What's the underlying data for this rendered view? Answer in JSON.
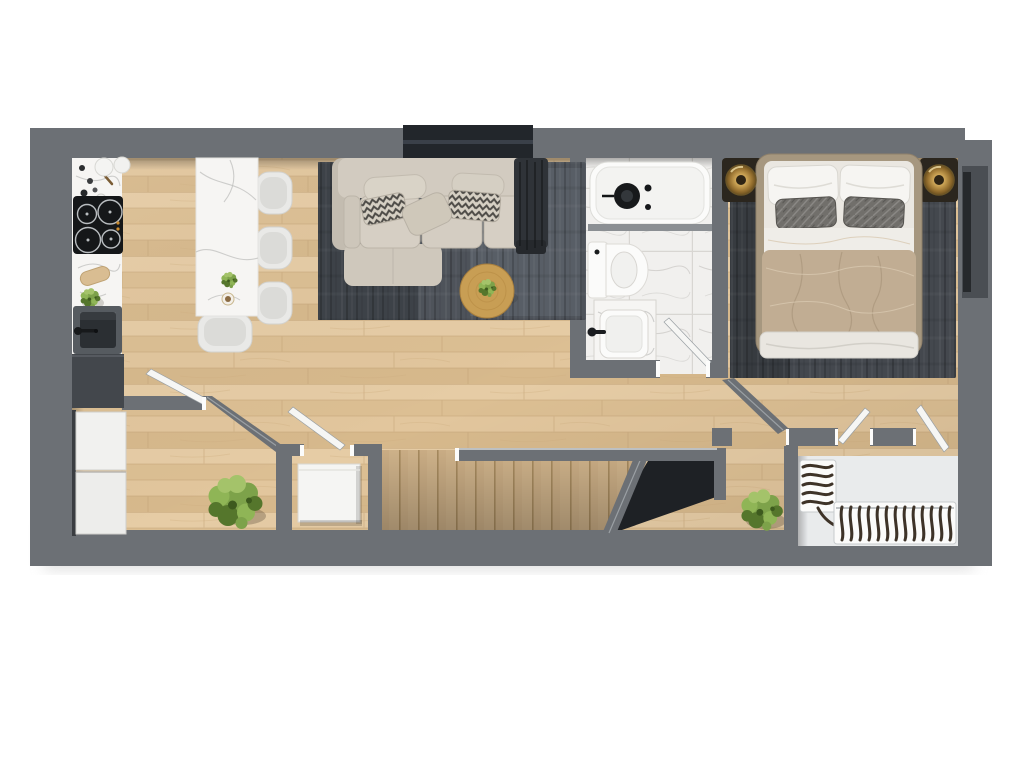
{
  "meta": {
    "title": "Apartment floor plan - photorealistic top-down 3D render",
    "view": "top-down orthographic",
    "text_visible": "none"
  },
  "colors": {
    "background": "#ffffff",
    "wall": "#6c7075",
    "wall_light": "#8d9196",
    "wall_dark": "#54585d",
    "window_dark": "#22262b",
    "floor_wood": "#e0c49a",
    "stair_wood": "#cdb189",
    "tile": "#f1f0ee",
    "marble": "#f6f5f3",
    "marble_vein": "#bfbfbd",
    "rug_living": "#4e535a",
    "rug_bedroom": "#44484e",
    "sofa": "#d2cbc0",
    "pillow_chevron": "#d8d2c6",
    "throw_dark": "#2f3338",
    "coffee_table": "#c89e54",
    "bed_frame": "#a6977f",
    "mattress": "#eae7e1",
    "duvet": "#c1ad93",
    "pillow_gray": "#716f6b",
    "lamp_gold": "#c9a75c",
    "plant_green": "#7da24a",
    "plant_green_dark": "#55762c",
    "appliance_dark": "#43474c",
    "sink_dark": "#2b2f33",
    "cooktop_black": "#151719",
    "fixture_white": "#fbfbfa",
    "void_dark": "#1e2125",
    "niche_floor": "#e9ebec",
    "radiator_fin": "#3e3328",
    "door_leaf": "#f6f6f4"
  },
  "rooms": {
    "kitchen": {
      "name": "Kitchen",
      "items": [
        "white marble countertop run",
        "black induction cooktop with 4 burners",
        "dark undermount sink with black faucet",
        "herb plant",
        "cutting board",
        "two round storage canisters",
        "tall dark cabinet",
        "two white appliance units"
      ]
    },
    "dining": {
      "name": "Dining area",
      "items": [
        "white marble dining island",
        "three side chairs",
        "one end chair",
        "small potted plant",
        "coffee cup"
      ]
    },
    "living": {
      "name": "Living room",
      "items": [
        "L-shaped beige sectional sofa",
        "chevron patterned pillows",
        "plain beige pillows",
        "dark throw blanket",
        "dark gray area rug",
        "round oak coffee table with plant",
        "window recess in top wall"
      ]
    },
    "bathroom": {
      "name": "Bathroom",
      "items": [
        "bathtub with black circular fitting",
        "toilet",
        "marble vanity with white vessel sink",
        "large-format marble tile floor",
        "open white door"
      ]
    },
    "bedroom": {
      "name": "Bedroom",
      "items": [
        "double bed with beige duvet",
        "two white pillows",
        "two gray quilted pillows",
        "white foot blanket",
        "two round brass sconce lamps",
        "dark gray area rug",
        "window recess in right wall",
        "open doors"
      ]
    },
    "hallway": {
      "name": "Hallway and stairs",
      "items": [
        "oak staircase with treads",
        "dark stairwell void",
        "angled partition walls",
        "large potted plant",
        "lower landing with potted plant"
      ]
    },
    "utility": {
      "name": "Utility closet",
      "items": [
        "white washer cabinet",
        "angled partition wall",
        "open door leaf"
      ]
    },
    "entry": {
      "name": "Entry niche",
      "items": [
        "L-shaped white radiator with dark fins",
        "open door to bedroom side"
      ]
    }
  },
  "materials": {
    "floor": "light oak plank",
    "walls": "gray concrete",
    "counters": "white marble"
  }
}
